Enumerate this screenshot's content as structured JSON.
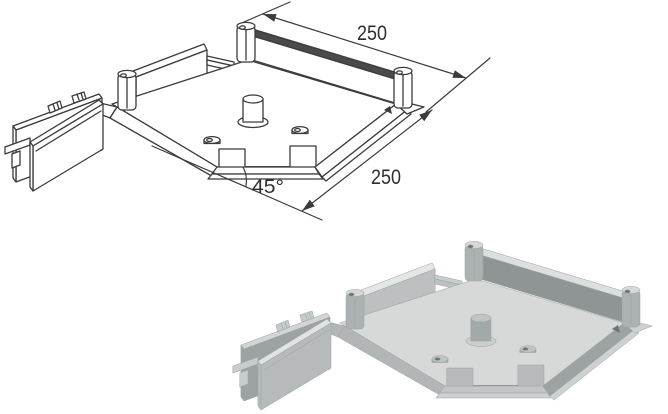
{
  "figure": {
    "title": "45° corner unit for underfloor trunking — isometric views",
    "dimensions": {
      "top_side": "250",
      "right_side": "250",
      "corner_angle": "45°"
    },
    "views": [
      {
        "id": "line-drawing",
        "label": "Dimensioned line drawing",
        "style": "outline"
      },
      {
        "id": "shaded-render",
        "label": "Shaded 3D render",
        "style": "grayscale-3d"
      }
    ],
    "colors": {
      "background": "#ffffff",
      "line_stroke": "#3b3b3b",
      "render_floor": "#d7d9d9",
      "render_wall_dark": "#8f9495",
      "render_wall_light": "#bcc0c1",
      "render_skirt": "#b2b6b7"
    }
  }
}
